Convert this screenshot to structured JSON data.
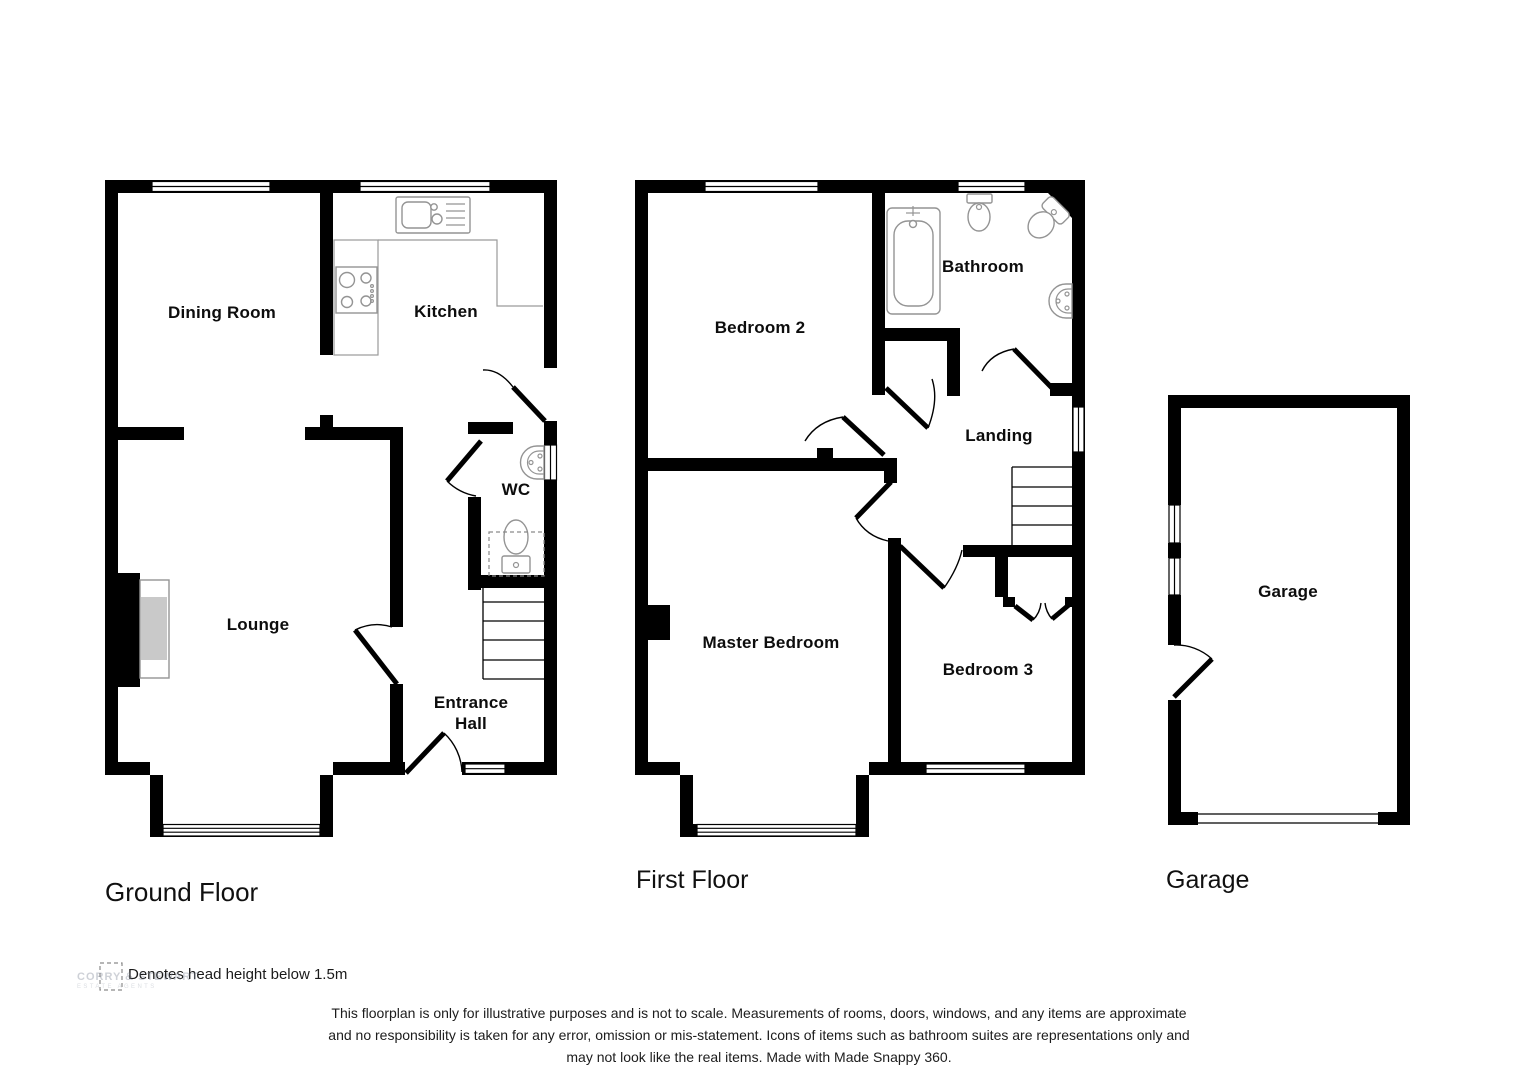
{
  "floors": [
    {
      "title": "Ground Floor",
      "rooms": [
        {
          "label": "Dining Room"
        },
        {
          "label": "Kitchen"
        },
        {
          "label": "WC"
        },
        {
          "label": "Lounge"
        },
        {
          "label": "Entrance Hall"
        }
      ]
    },
    {
      "title": "First Floor",
      "rooms": [
        {
          "label": "Bedroom 2"
        },
        {
          "label": "Bathroom"
        },
        {
          "label": "Landing"
        },
        {
          "label": "Master Bedroom"
        },
        {
          "label": "Bedroom 3"
        }
      ]
    },
    {
      "title": "Garage",
      "rooms": [
        {
          "label": "Garage"
        }
      ]
    }
  ],
  "legend": {
    "text": "Denotes head height below 1.5m"
  },
  "watermark": {
    "name": "CORRY & STEWART",
    "tagline": "ESTATE AGENTS"
  },
  "disclaimer": {
    "lines": [
      "This floorplan is only for illustrative purposes and is not to scale. Measurements of rooms, doors, windows, and any items are approximate",
      "and no responsibility is taken for any error, omission or mis-statement. Icons of items such as bathroom suites are representations only and",
      "may not look like the real items. Made with Made Snappy 360."
    ]
  },
  "colors": {
    "wall": "#000000",
    "fixture_outline": "#949494",
    "hearth": "#c9c9c9",
    "background": "#ffffff"
  }
}
